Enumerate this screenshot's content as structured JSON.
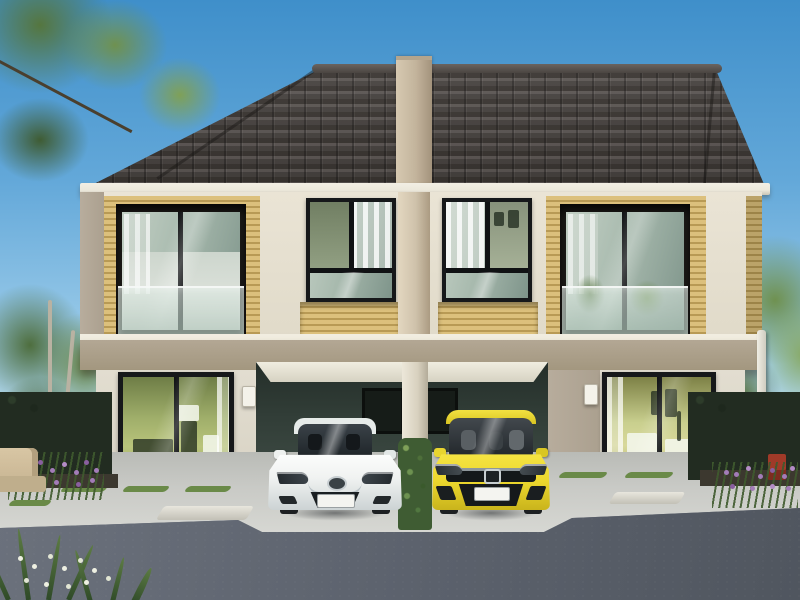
{
  "meta": {
    "kind": "architectural-exterior-photo",
    "width": 800,
    "height": 600,
    "visible_text": "none"
  },
  "scene": {
    "title": "Twin two-storey townhouse (duplex) exterior render, daytime",
    "description": "Symmetric two-unit townhouse with dark grey tiled gable roof, centre party-wall pillar, yellow timber-slat accent panels with recessed glass balconies on the upper floor, two centre bedroom windows, twin carports below with a white sedan (left) and a yellow hatchback (right), full-height sliding glass doors on each unit, landscaped hedges with purple flowers, concrete walkway and asphalt road in the foreground, trees and blue sky behind",
    "house": {
      "roof": "dark grey-brown concrete tile gable with centre firewall cap",
      "upper_floor": [
        "left yellow-slat accent panel with recessed balcony and glass balustrade",
        "left unit bedroom window with white curtains",
        "centre party-wall pillar",
        "right unit bedroom window with white curtains",
        "right yellow-slat accent panel with recessed balcony, plants and glass balustrade",
        "yellow slat bands under both centre windows",
        "taupe string-course band between floors"
      ],
      "ground_floor": [
        "left sliding glass door with lit green interior",
        "left doorbell panel",
        "twin carport with dark green rear wall and two small windows",
        "centre carport pillar wrapped in green hedge",
        "right sliding glass door with warm lit interior",
        "right doorbell panel",
        "white downspout at right corner"
      ]
    },
    "vehicles": [
      {
        "name": "white-sedan",
        "style": "Mazda-type saloon, front view",
        "body_color_key": "car_white",
        "details": [
          "dark windshield",
          "chrome grille wing",
          "round badge",
          "blank white licence plate",
          "dark lower grille"
        ]
      },
      {
        "name": "yellow-hatchback",
        "style": "Honda-type hatchback, front view",
        "body_color_key": "car_yellow",
        "details": [
          "large dark windshield with seats",
          "black grille band with badge",
          "blank white licence plate",
          "black lower intake"
        ]
      }
    ],
    "landscape": [
      "overhanging tree branch top-left",
      "slender trees left of house",
      "dark clipped hedges both sides",
      "purple flower beds",
      "outdoor beige sofa far left",
      "red garden chair right",
      "paver walkway with grass joints",
      "concrete driveway apron",
      "asphalt road",
      "white crinum flowers bottom-left foreground"
    ],
    "colors": {
      "sky_top": "#3f8fca",
      "sky_low": "#a6d2ec",
      "roof_dark": "#46413e",
      "roof_light": "#5d5754",
      "fascia": "#ece8db",
      "firewall": "#c3b49c",
      "wall_cream": "#eae4d5",
      "wall_taupe": "#aba08f",
      "slat_light": "#dcc07c",
      "slat_dark": "#b89a55",
      "band_taupe": "#b3a794",
      "ground_wall": "#e2ddd0",
      "carport_dark": "#313d37",
      "carport_mid": "#3d4a43",
      "frame_black": "#16181a",
      "glass_cool": "#a8baae",
      "glass_deep": "#7e948a",
      "interior_warm": "#b9c47b",
      "hedge_dark": "#222c21",
      "foliage": "#5d7c44",
      "foliage_light": "#7fa058",
      "flower_purple": "#a37cb8",
      "grass": "#6a8a48",
      "trunk": "#b9b2a2",
      "concrete": "#c9cac6",
      "road_mid": "#6b717c",
      "road_dark": "#50565f",
      "soil": "#3c382f",
      "car_white": "#f0f2f1",
      "car_yellow": "#ecd72e",
      "chair_red": "#a03a28",
      "sofa_tan": "#c9b694",
      "plate_white": "#f4f4f0"
    }
  }
}
